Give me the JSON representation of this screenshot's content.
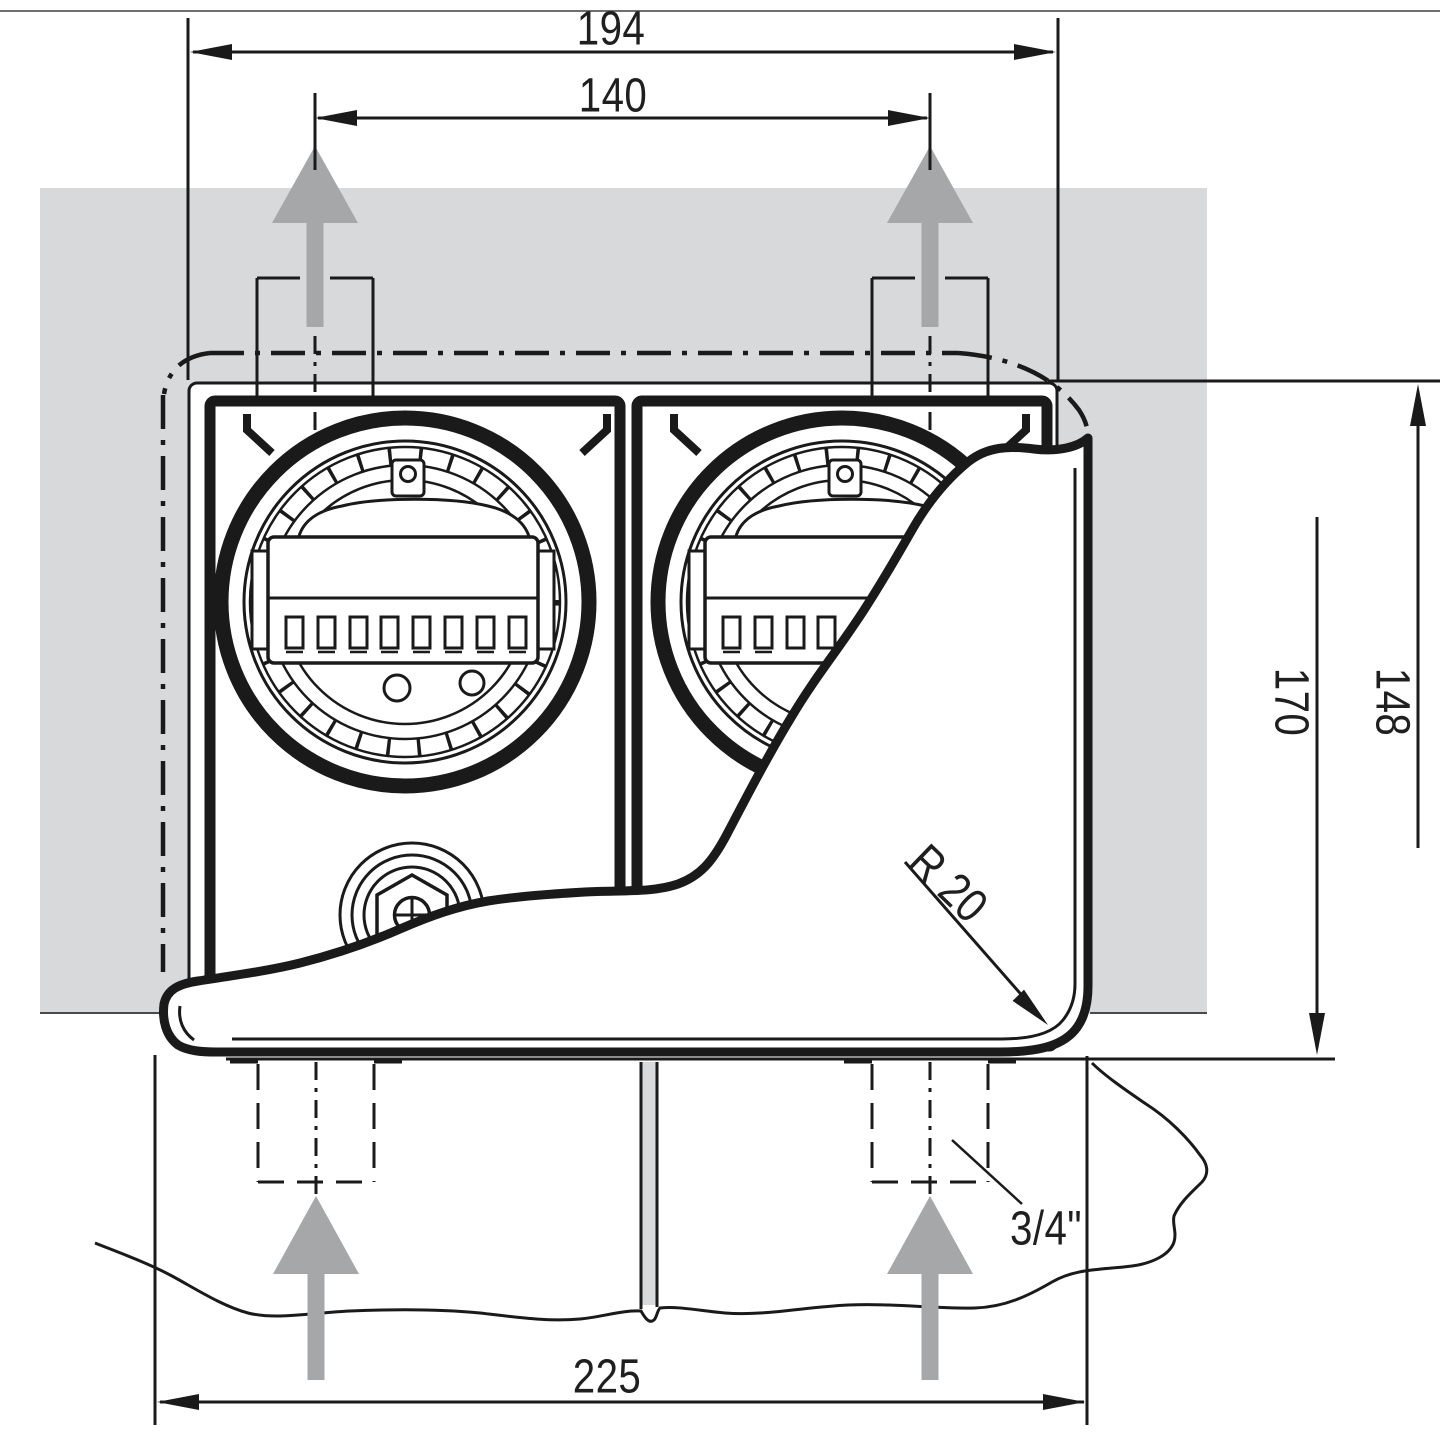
{
  "drawing": {
    "type": "technical-dimension-drawing",
    "subject": "flush-mount twin meter enclosure, front view with torn-away cover",
    "colors": {
      "line": "#1a1a1a",
      "wall_fill": "#d8d9da",
      "flow_arrow_fill": "#a5a7a9",
      "paper": "#ffffff"
    },
    "dimensions": {
      "width_outer": {
        "label": "194"
      },
      "width_holes": {
        "label": "140"
      },
      "width_cover": {
        "label": "225"
      },
      "height_full": {
        "label": "170"
      },
      "height_body": {
        "label": "148"
      },
      "corner_radius": {
        "label": "R 20"
      },
      "conduit_thread": {
        "label": "3/4\""
      }
    },
    "icons": [
      "up-arrow-top-left",
      "up-arrow-top-right",
      "up-arrow-bottom-left",
      "up-arrow-bottom-right"
    ]
  }
}
